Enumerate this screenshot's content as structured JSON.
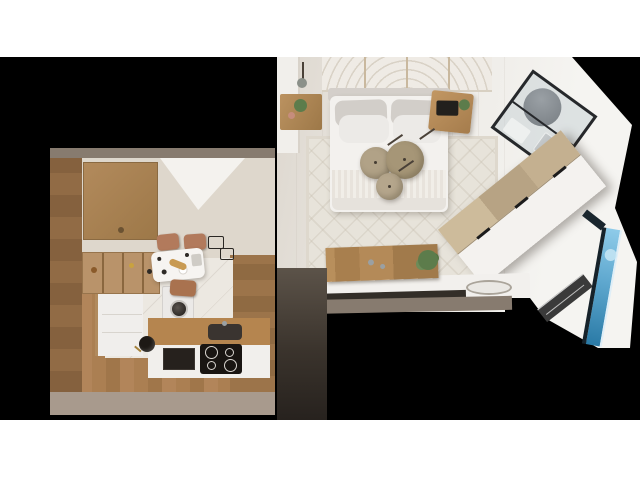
{
  "scene": {
    "title": "Studio apartment top-down 3D render",
    "description": "Photorealistic bird's-eye 3D render of a small studio apartment floor plan on a black background with white letterbox bands. Bedroom with double bed at top centre, angled glass-walled shower room at top right, diagonal wardrobe on the right, blue glazed window slot on the lower right edge, vanity console with basin at bottom centre, and an L-shaped kitchen with dining table on the left.",
    "rooms": [
      {
        "name": "bedroom",
        "furniture": [
          "decorative-headboard-panel",
          "double-bed",
          "gray-pillows",
          "white-pillows",
          "striped-throw",
          "left-wall-shelf-with-plants",
          "right-nightstand-with-tablet",
          "patterned-rug",
          "three-pendant-lamps",
          "pendant-lamp-left"
        ]
      },
      {
        "name": "shower-room",
        "furniture": [
          "black-framed-glass-enclosure",
          "round-gray-shower-tray",
          "gray-lounger",
          "white-mat",
          "glass-partition"
        ]
      },
      {
        "name": "dressing-area",
        "furniture": [
          "diagonal-wardrobe-wood-front",
          "wardrobe-black-handles",
          "radiator-shelf",
          "blue-window-slot"
        ]
      },
      {
        "name": "vanity-area",
        "furniture": [
          "wood-backsplash-panel",
          "chrome-faucets",
          "white-counter",
          "oval-basin",
          "green-plant"
        ]
      },
      {
        "name": "kitchen",
        "furniture": [
          "upper-wood-cabinet",
          "open-shelf-row",
          "tall-white-cabinet",
          "washing-machine",
          "wood-countertop",
          "dark-sink",
          "induction-cooktop-4-burners",
          "black-oven",
          "dining-table-with-food",
          "two-terracotta-chairs",
          "third-chair",
          "black-stool"
        ]
      }
    ]
  },
  "palette": {
    "background": "#000000",
    "band_white": "#ffffff",
    "bedroom_floor": "#d8d2c9",
    "bedroom_floor_bright": "#f0eeea",
    "rug": "#e7e3da",
    "deco_panel": "#efebe5",
    "headboard": "#d4cfca",
    "bed_white": "#f3f1ee",
    "pillow_gray": "#d2cec9",
    "pillow_white": "#eceae7",
    "pouf_beige": "#b1a287",
    "pouf_beige_dark": "#a69677",
    "pouf_beige_light": "#b5a68c",
    "nightstand_wood": "#b78e5c",
    "tablet_black": "#22201d",
    "plant_green": "#5c7c4b",
    "plant_pink": "#c68d7c",
    "glass_frame": "#26282b",
    "shower_gray": "#878d92",
    "lounger_gray": "#c5c9cb",
    "wardrobe_wood": "#c9b795",
    "wardrobe_white": "#f4f2ef",
    "handle_black": "#1c1c1c",
    "vanity_wood": "#ae8756",
    "counter_white": "#f2f0ed",
    "basin_fill": "#eae8e4",
    "under_counter_dark": "#332e28",
    "wall_taupe": "#877b6f",
    "pillar_dark": "#4f463d",
    "kitchen_floor_wood": "#a87c4f",
    "kitchen_tile_white": "#ece8e1",
    "cabinet_wood": "#b28a5c",
    "counter_wood": "#b5854f",
    "sink_dark": "#3a3430",
    "appliance_black": "#191512",
    "washer_white": "#ebe9e7",
    "chair_terracotta": "#b27a5c",
    "table_white": "#f6f4f1",
    "bread_gold": "#c89a52",
    "food_dark": "#2e2a26",
    "window_blue": "#79bfe4",
    "window_blue_deep": "#2a7aa6",
    "window_frame": "#16222a",
    "radiator_dark": "#3a3a3a"
  }
}
